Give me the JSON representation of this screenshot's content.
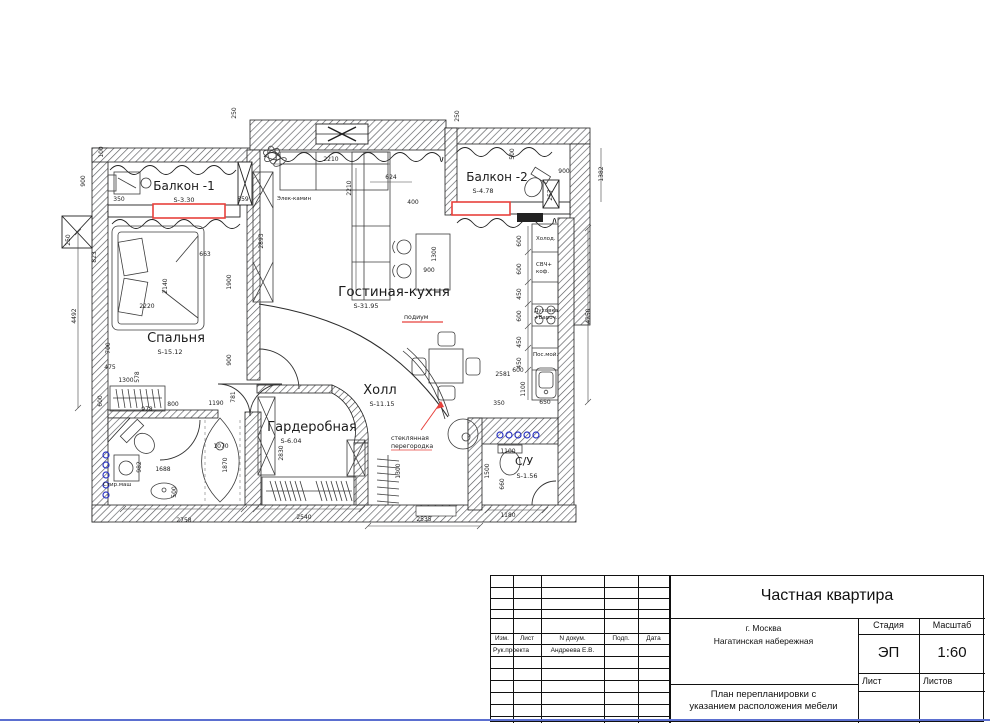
{
  "titleblock": {
    "project": "Частная квартира",
    "address_line1": "г. Москва",
    "address_line2": "Нагатинская набережная",
    "stage_label": "Стадия",
    "scale_label": "Масштаб",
    "stage_value": "ЭП",
    "scale_value": "1:60",
    "sheet_label": "Лист",
    "sheets_label": "Листов",
    "doc_title_line1": "План перепланировки с",
    "doc_title_line2": "указанием расположения мебели",
    "cols": [
      "Изм.",
      "Лист",
      "N докум.",
      "Подп.",
      "Дата"
    ],
    "row_role": "Рук.проекта",
    "row_name": "Андреева Е.В."
  },
  "plan": {
    "rooms": [
      {
        "name": "Балкон -1",
        "area": "S-3.30",
        "x": 184,
        "y": 190,
        "ax": 184,
        "ay": 202,
        "fs": 12
      },
      {
        "name": "Балкон -2",
        "area": "S-4.78",
        "x": 497,
        "y": 181,
        "ax": 483,
        "ay": 193,
        "fs": 12
      },
      {
        "name": "Спальня",
        "area": "S-15.12",
        "x": 176,
        "y": 342,
        "ax": 170,
        "ay": 354,
        "fs": 13
      },
      {
        "name": "Гостиная-кухня",
        "area": "S-31.95",
        "x": 394,
        "y": 296,
        "ax": 366,
        "ay": 308,
        "fs": 13.5
      },
      {
        "name": "Холл",
        "area": "S-11.15",
        "x": 380,
        "y": 394,
        "ax": 382,
        "ay": 406,
        "fs": 13
      },
      {
        "name": "Гардеробная",
        "area": "S-6.04",
        "x": 312,
        "y": 431,
        "ax": 291,
        "ay": 443,
        "fs": 13
      },
      {
        "name": "С/У",
        "area": "S-1.56",
        "x": 524,
        "y": 465,
        "ax": 527,
        "ay": 478,
        "fs": 11
      }
    ],
    "labels": [
      {
        "t": "Элек-камин",
        "x": 277,
        "y": 200
      },
      {
        "t": "Холод.",
        "x": 536,
        "y": 240
      },
      {
        "t": "СВЧ+",
        "x": 536,
        "y": 266
      },
      {
        "t": "коф.",
        "x": 536,
        "y": 273
      },
      {
        "t": "Духовка",
        "x": 534,
        "y": 312
      },
      {
        "t": "+Вароч.",
        "x": 534,
        "y": 319
      },
      {
        "t": "Пос.мой.",
        "x": 533,
        "y": 356
      },
      {
        "t": "Стир.маш",
        "x": 103,
        "y": 486
      }
    ],
    "red_notes": [
      {
        "t": "подиум",
        "x": 404,
        "y": 319
      },
      {
        "t": "стеклянная",
        "x": 391,
        "y": 440
      },
      {
        "t": "перегородка",
        "x": 391,
        "y": 448
      }
    ],
    "dims": [
      {
        "v": "250",
        "x": 236,
        "y": 113,
        "r": 1
      },
      {
        "v": "100",
        "x": 103,
        "y": 152,
        "r": 1
      },
      {
        "v": "900",
        "x": 85,
        "y": 181,
        "r": 1
      },
      {
        "v": "350",
        "x": 119,
        "y": 201,
        "r": 0
      },
      {
        "v": "859",
        "x": 243,
        "y": 201,
        "r": 0
      },
      {
        "v": "250",
        "x": 459,
        "y": 116,
        "r": 1
      },
      {
        "v": "500",
        "x": 514,
        "y": 154,
        "r": 1
      },
      {
        "v": "900",
        "x": 564,
        "y": 173,
        "r": 0
      },
      {
        "v": "1382",
        "x": 603,
        "y": 174,
        "r": 1
      },
      {
        "v": "257",
        "x": 552,
        "y": 195,
        "r": 1
      },
      {
        "v": "400",
        "x": 413,
        "y": 204,
        "r": 0
      },
      {
        "v": "2210",
        "x": 331,
        "y": 161,
        "r": 0
      },
      {
        "v": "2210",
        "x": 351,
        "y": 188,
        "r": 1
      },
      {
        "v": "624",
        "x": 391,
        "y": 179,
        "r": 0
      },
      {
        "v": "250",
        "x": 70,
        "y": 240,
        "r": 1
      },
      {
        "v": "4492",
        "x": 76,
        "y": 316,
        "r": 1
      },
      {
        "v": "823",
        "x": 96,
        "y": 257,
        "r": 1
      },
      {
        "v": "2140",
        "x": 167,
        "y": 286,
        "r": 1
      },
      {
        "v": "2220",
        "x": 147,
        "y": 308,
        "r": 0
      },
      {
        "v": "663",
        "x": 205,
        "y": 256,
        "r": 0
      },
      {
        "v": "1900",
        "x": 231,
        "y": 282,
        "r": 1
      },
      {
        "v": "2893",
        "x": 263,
        "y": 241,
        "r": 1
      },
      {
        "v": "700",
        "x": 110,
        "y": 348,
        "r": 1
      },
      {
        "v": "475",
        "x": 110,
        "y": 369,
        "r": 0
      },
      {
        "v": "578",
        "x": 139,
        "y": 377,
        "r": 1
      },
      {
        "v": "1300",
        "x": 126,
        "y": 382,
        "r": 0
      },
      {
        "v": "600",
        "x": 102,
        "y": 401,
        "r": 1
      },
      {
        "v": "978",
        "x": 147,
        "y": 411,
        "r": 0
      },
      {
        "v": "800",
        "x": 173,
        "y": 406,
        "r": 0
      },
      {
        "v": "1190",
        "x": 216,
        "y": 405,
        "r": 0
      },
      {
        "v": "900",
        "x": 231,
        "y": 360,
        "r": 1
      },
      {
        "v": "781",
        "x": 235,
        "y": 397,
        "r": 1
      },
      {
        "v": "982",
        "x": 141,
        "y": 467,
        "r": 1
      },
      {
        "v": "1688",
        "x": 163,
        "y": 471,
        "r": 0
      },
      {
        "v": "500",
        "x": 176,
        "y": 492,
        "r": 1
      },
      {
        "v": "1070",
        "x": 221,
        "y": 448,
        "r": 0
      },
      {
        "v": "1870",
        "x": 227,
        "y": 465,
        "r": 1
      },
      {
        "v": "2830",
        "x": 283,
        "y": 453,
        "r": 1
      },
      {
        "v": "1300",
        "x": 400,
        "y": 471,
        "r": 1
      },
      {
        "v": "2758",
        "x": 184,
        "y": 522,
        "r": 0
      },
      {
        "v": "2540",
        "x": 304,
        "y": 519,
        "r": 0
      },
      {
        "v": "2535",
        "x": 424,
        "y": 521,
        "r": 0
      },
      {
        "v": "1180",
        "x": 508,
        "y": 517,
        "r": 0
      },
      {
        "v": "1300",
        "x": 436,
        "y": 254,
        "r": 1
      },
      {
        "v": "900",
        "x": 429,
        "y": 272,
        "r": 0
      },
      {
        "v": "600",
        "x": 521,
        "y": 241,
        "r": 1
      },
      {
        "v": "600",
        "x": 521,
        "y": 269,
        "r": 1
      },
      {
        "v": "450",
        "x": 521,
        "y": 294,
        "r": 1
      },
      {
        "v": "600",
        "x": 521,
        "y": 316,
        "r": 1
      },
      {
        "v": "450",
        "x": 521,
        "y": 342,
        "r": 1
      },
      {
        "v": "450",
        "x": 521,
        "y": 363,
        "r": 1
      },
      {
        "v": "600",
        "x": 518,
        "y": 372,
        "r": 0
      },
      {
        "v": "1100",
        "x": 525,
        "y": 389,
        "r": 1
      },
      {
        "v": "650",
        "x": 545,
        "y": 404,
        "r": 0
      },
      {
        "v": "350",
        "x": 499,
        "y": 405,
        "r": 0
      },
      {
        "v": "2581",
        "x": 503,
        "y": 376,
        "r": 0
      },
      {
        "v": "4250",
        "x": 590,
        "y": 316,
        "r": 1
      },
      {
        "v": "1100",
        "x": 508,
        "y": 453,
        "r": 0
      },
      {
        "v": "1500",
        "x": 489,
        "y": 471,
        "r": 1
      },
      {
        "v": "660",
        "x": 504,
        "y": 484,
        "r": 1
      }
    ],
    "colors": {
      "red": "#e8413c",
      "blue": "#2c36c4",
      "line": "#222222"
    }
  }
}
